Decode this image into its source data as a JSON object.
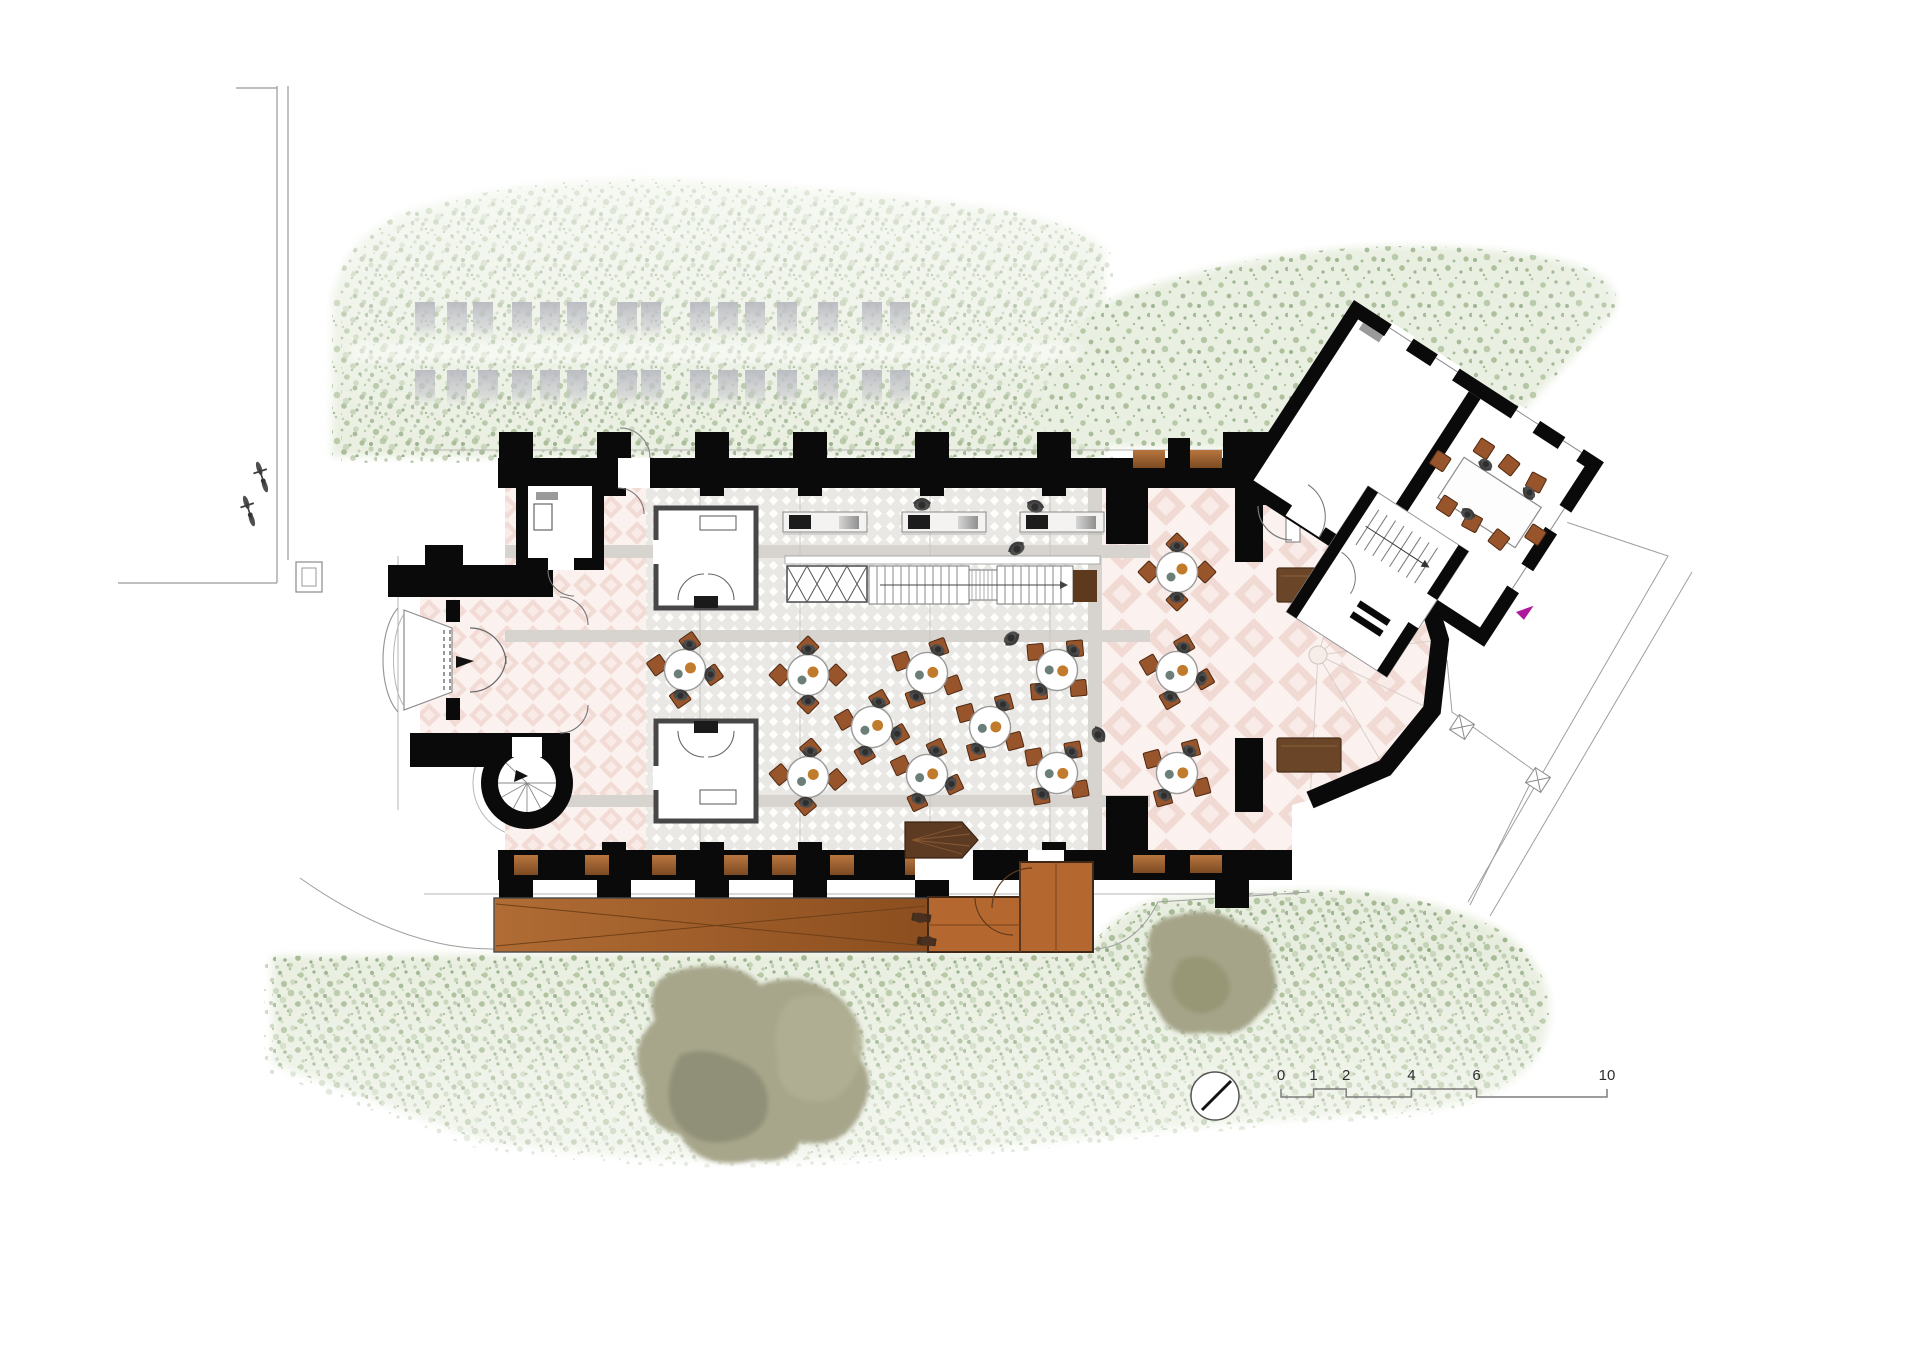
{
  "document": {
    "title": "Church conversion ground-floor plan",
    "type": "architectural-floor-plan"
  },
  "scale_bar": {
    "unit": "m",
    "labels": [
      "0",
      "1",
      "2",
      "4",
      "6",
      "10"
    ],
    "px_per_meter": 32.6
  },
  "north_arrow": {
    "style": "circle-with-needle"
  },
  "palette": {
    "wall_black": "#0a0a0a",
    "lawn_base": "#e8eedf",
    "lawn_speckle": "#9db48f",
    "tree_olive": "#a7a68b",
    "tile_pink": "#f2dbd5",
    "carpet_grey": "#eae8e4",
    "walkway_grey": "#d7d3ce",
    "wood_ramp": "#a05e28",
    "wood_deck": "#b4672e",
    "chair_brown": "#98542b",
    "bench_brown": "#6b4527",
    "person_grey": "#4d4d4d",
    "gravestone_grey": "#b9bac1",
    "exit_arrow_magenta": "#b0189b"
  },
  "site": {
    "gravestone_rows": [
      {
        "y": 302,
        "xs": [
          415,
          447,
          473,
          512,
          540,
          567,
          617,
          641,
          690,
          718,
          745,
          777,
          818,
          862,
          890
        ]
      },
      {
        "y": 370,
        "xs": [
          415,
          447,
          478,
          512,
          540,
          567,
          617,
          641,
          690,
          718,
          745,
          777,
          818,
          862,
          890
        ]
      }
    ],
    "bicycles": [
      {
        "x": 262,
        "y": 477,
        "rot": -18
      },
      {
        "x": 249,
        "y": 511,
        "rot": -18
      }
    ],
    "standing_people": [
      {
        "x": 1017,
        "y": 549,
        "rot": -30
      },
      {
        "x": 1011,
        "y": 638,
        "rot": 140
      },
      {
        "x": 1098,
        "y": 735,
        "rot": 60
      },
      {
        "x": 922,
        "y": 505,
        "rot": 0
      },
      {
        "x": 1035,
        "y": 507,
        "rot": 15
      }
    ],
    "terrace_seats": [
      {
        "x": 921,
        "y": 917,
        "rot": 10
      },
      {
        "x": 927,
        "y": 942,
        "rot": 190
      }
    ]
  },
  "furniture": {
    "round_tables": [
      {
        "x": 685,
        "y": 670,
        "rot": 10,
        "people": 3
      },
      {
        "x": 808,
        "y": 675,
        "rot": 0,
        "people": 2
      },
      {
        "x": 927,
        "y": 673,
        "rot": 25,
        "people": 2
      },
      {
        "x": 1057,
        "y": 670,
        "rot": 40,
        "people": 2
      },
      {
        "x": 872,
        "y": 727,
        "rot": 15,
        "people": 3
      },
      {
        "x": 990,
        "y": 727,
        "rot": 30,
        "people": 2
      },
      {
        "x": 808,
        "y": 777,
        "rot": 5,
        "people": 2
      },
      {
        "x": 927,
        "y": 775,
        "rot": 20,
        "people": 3
      },
      {
        "x": 1057,
        "y": 773,
        "rot": 35,
        "people": 2
      },
      {
        "x": 1177,
        "y": 572,
        "rot": 0,
        "people": 2
      },
      {
        "x": 1177,
        "y": 672,
        "rot": 15,
        "people": 3
      },
      {
        "x": 1177,
        "y": 773,
        "rot": 30,
        "people": 2
      }
    ],
    "counters": [
      {
        "x": 783
      },
      {
        "x": 902
      },
      {
        "x": 1020
      }
    ],
    "apse_benches": [
      {
        "x": 1277,
        "y": 568
      },
      {
        "x": 1277,
        "y": 738
      }
    ],
    "annex_chairs": [
      {
        "x": 190,
        "y": 54,
        "rot": 0
      },
      {
        "x": 220,
        "y": 54,
        "rot": 5
      },
      {
        "x": 252,
        "y": 54,
        "rot": -5
      },
      {
        "x": 190,
        "y": 122,
        "rot": 180
      },
      {
        "x": 220,
        "y": 122,
        "rot": 175
      },
      {
        "x": 252,
        "y": 122,
        "rot": 185
      },
      {
        "x": 160,
        "y": 88,
        "rot": 270
      },
      {
        "x": 280,
        "y": 98,
        "rot": 90
      }
    ],
    "annex_people": [
      {
        "x": 200,
        "y": 66,
        "rot": 180
      },
      {
        "x": 252,
        "y": 66,
        "rot": 200
      },
      {
        "x": 212,
        "y": 118,
        "rot": 0
      }
    ]
  }
}
